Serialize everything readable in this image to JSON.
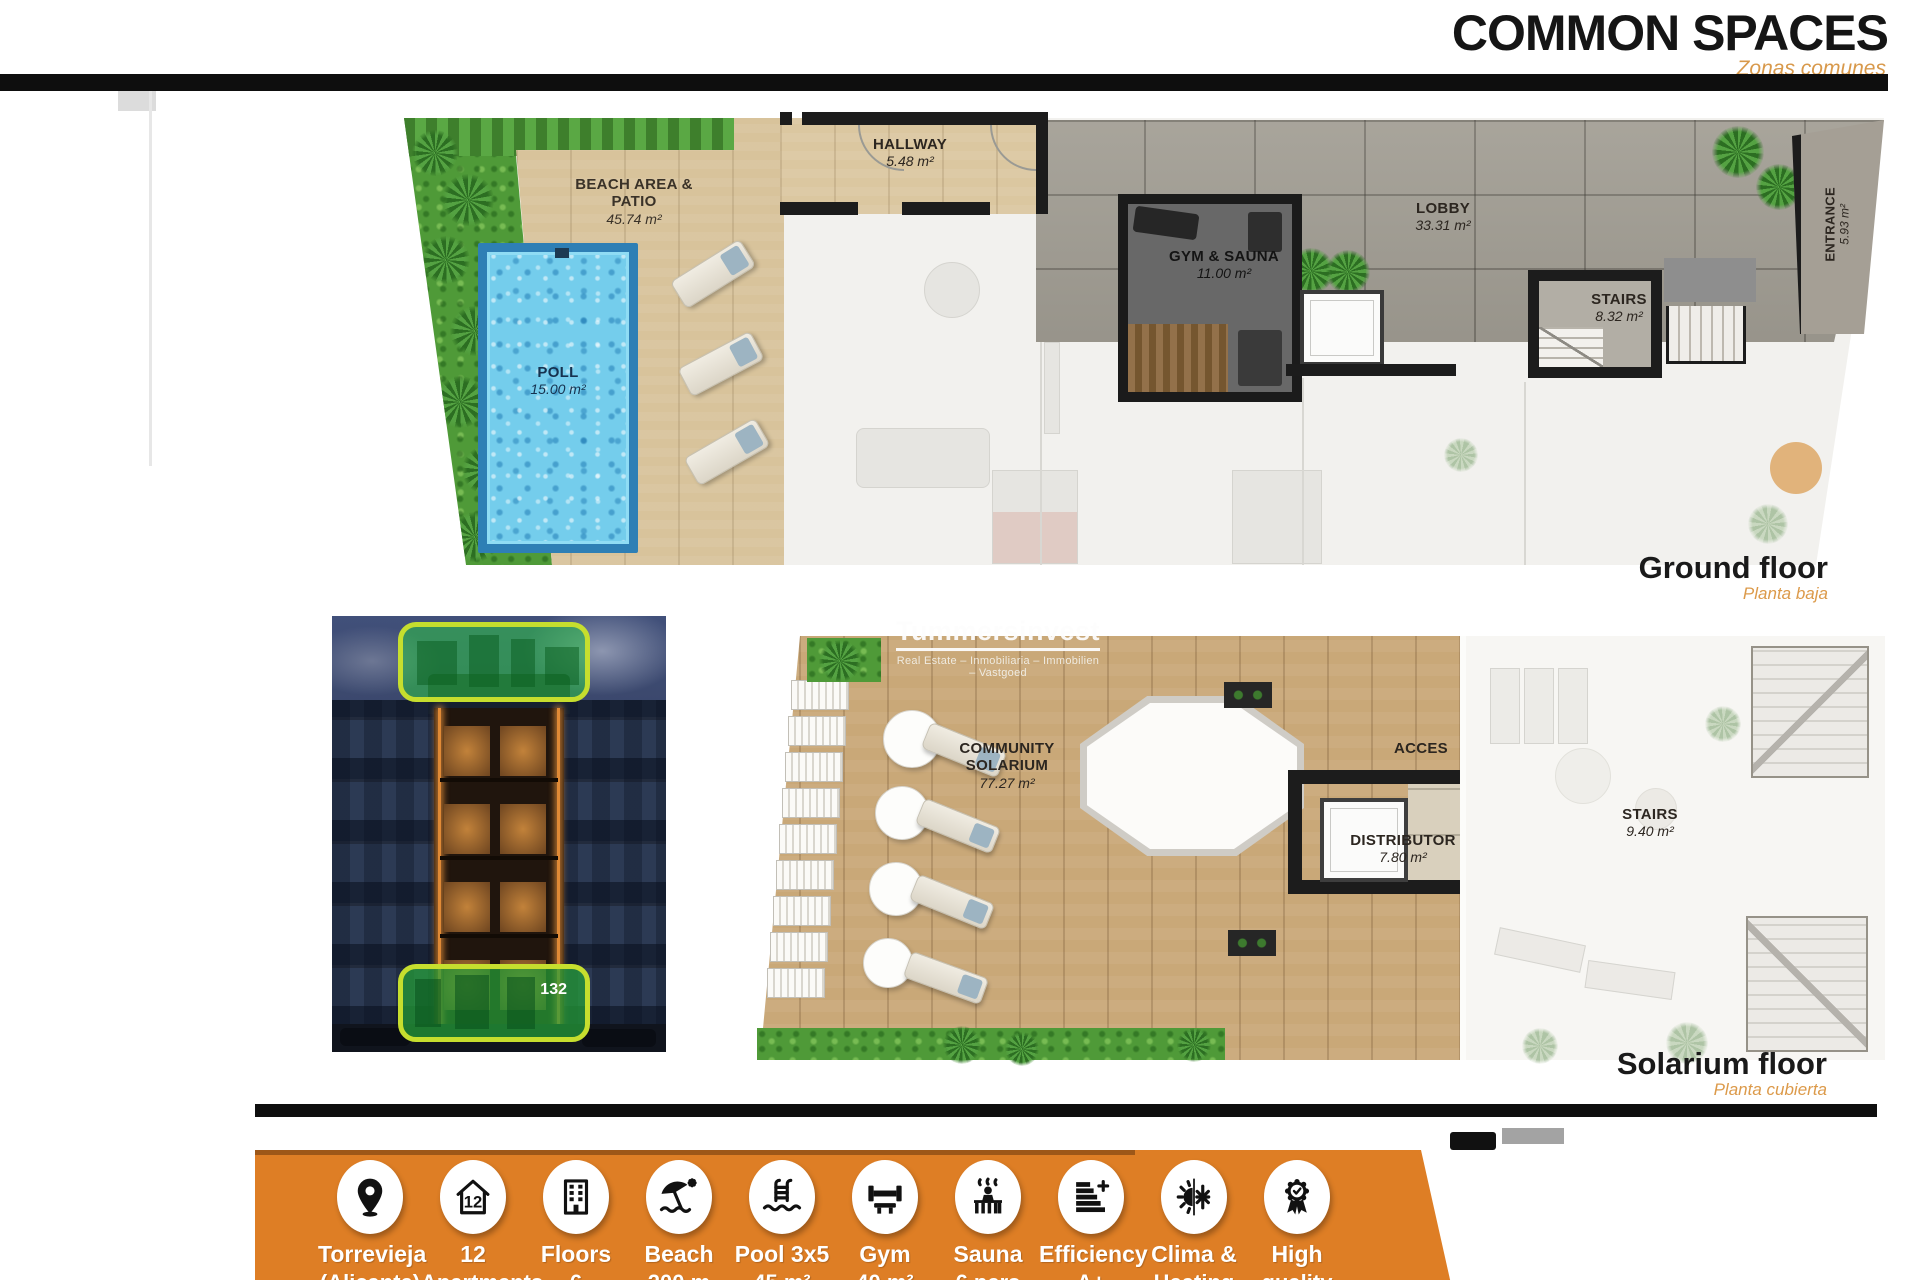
{
  "header": {
    "title": "COMMON SPACES",
    "subtitle": "Zonas comunes"
  },
  "ground_floor": {
    "caption": "Ground floor",
    "caption_es": "Planta baja",
    "beach": {
      "name": "BEACH AREA & PATIO",
      "area": "45.74 m²"
    },
    "pool": {
      "name": "POLL",
      "area": "15.00 m²"
    },
    "hallway": {
      "name": "HALLWAY",
      "area": "5.48 m²"
    },
    "gym": {
      "name": "GYM & SAUNA",
      "area": "11.00 m²"
    },
    "lobby": {
      "name": "LOBBY",
      "area": "33.31 m²"
    },
    "stairs": {
      "name": "STAIRS",
      "area": "8.32 m²"
    },
    "entrance": {
      "name": "ENTRANCE",
      "area": "5.93 m²"
    }
  },
  "solarium_floor": {
    "caption": "Solarium floor",
    "caption_es": "Planta cubierta",
    "solarium": {
      "name_line1": "COMMUNITY",
      "name_line2": "SOLARIUM",
      "area": "77.27 m²"
    },
    "acces": {
      "name": "ACCES"
    },
    "distributor": {
      "name": "DISTRIBUTOR",
      "area": "7.80 m²"
    },
    "stairs": {
      "name": "STAIRS",
      "area": "9.40 m²"
    }
  },
  "watermark": {
    "brand": "Tummersinvest",
    "tagline": "Real Estate – Inmobiliaria – Immobilien – Vastgoed"
  },
  "building_photo": {
    "badge": "132"
  },
  "features": [
    {
      "icon": "location-pin-icon",
      "line1": "Torrevieja",
      "line2": "(Alicante)"
    },
    {
      "icon": "apartments-count-icon",
      "line1": "12",
      "line2": "Apartments"
    },
    {
      "icon": "floors-icon",
      "line1": "Floors",
      "line2": "6"
    },
    {
      "icon": "beach-icon",
      "line1": "Beach",
      "line2": "200 m"
    },
    {
      "icon": "pool-icon",
      "line1": "Pool 3x5",
      "line2": "45 m²"
    },
    {
      "icon": "gym-icon",
      "line1": "Gym",
      "line2": "40 m²"
    },
    {
      "icon": "sauna-icon",
      "line1": "Sauna",
      "line2": "6 pers"
    },
    {
      "icon": "efficiency-icon",
      "line1": "Efficiency",
      "line2": "A+"
    },
    {
      "icon": "climate-icon",
      "line1": "Clima &",
      "line2": "Heating"
    },
    {
      "icon": "quality-icon",
      "line1": "High",
      "line2": "quality"
    }
  ],
  "colors": {
    "accent_orange": "#DE7E25",
    "subtitle_orange": "#D8994B",
    "highlight_green": "#35C435",
    "highlight_border": "#C6DE2E",
    "pool_blue": "#74CDEC",
    "wall_black": "#1C1C1C"
  }
}
